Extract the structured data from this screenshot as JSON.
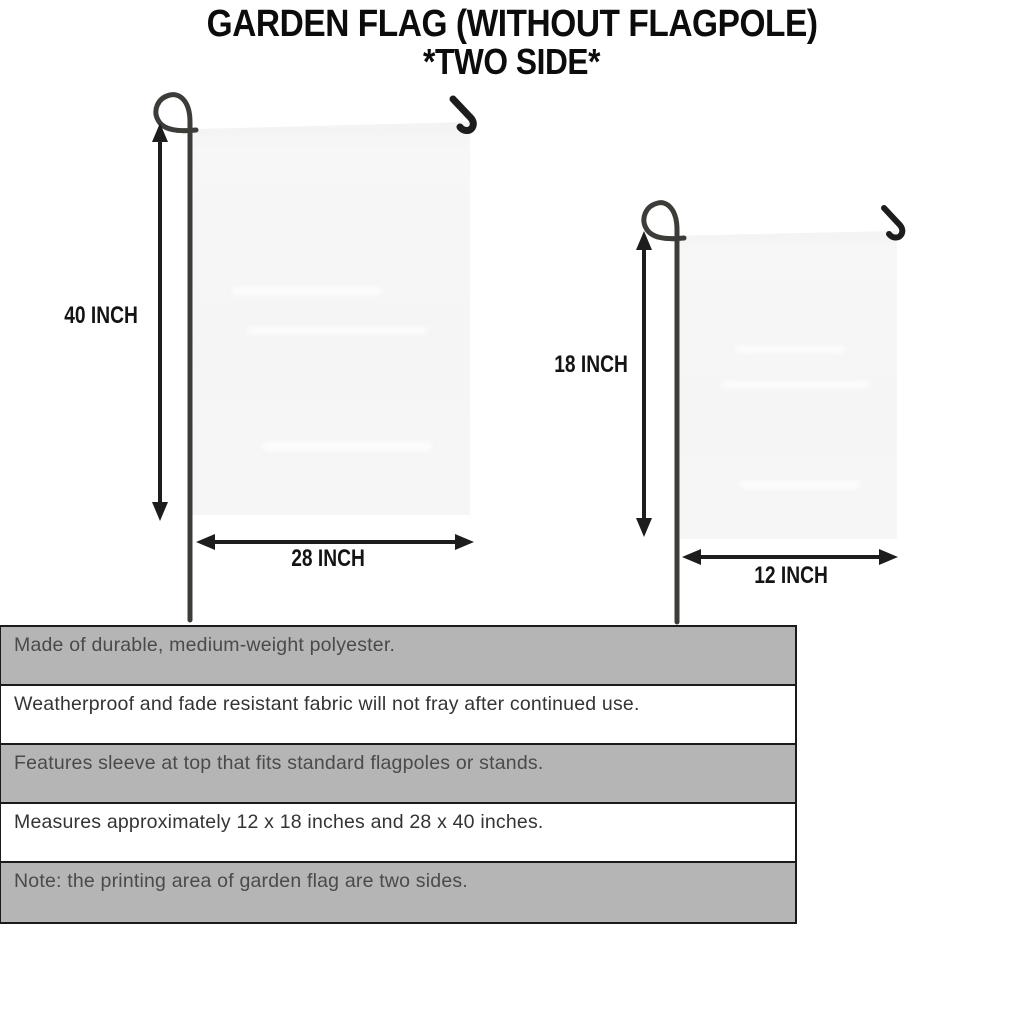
{
  "title": {
    "line1": "GARDEN FLAG (WITHOUT FLAGPOLE)",
    "line2": "*TWO SIDE*"
  },
  "flags": {
    "large": {
      "height_label": "40 INCH",
      "width_label": "28 INCH"
    },
    "small": {
      "height_label": "18 INCH",
      "width_label": "12 INCH"
    }
  },
  "specs": {
    "rows": [
      {
        "text": "Made of durable, medium-weight polyester."
      },
      {
        "text": "Weatherproof and fade resistant fabric will not fray after continued use."
      },
      {
        "text": "Features sleeve at top that fits standard flagpoles or stands."
      },
      {
        "text": "Measures approximately 12 x 18 inches and 28 x 40 inches."
      },
      {
        "text": "Note: the printing area of garden flag are two sides."
      }
    ]
  },
  "colors": {
    "table_row_gray": "#b5b5b5",
    "table_border": "#1b1b1b",
    "flag_fill": "#f6f6f6",
    "pole": "#3e3c38",
    "line_art": "#1d1d1d",
    "title_text": "#0c0c0c"
  }
}
